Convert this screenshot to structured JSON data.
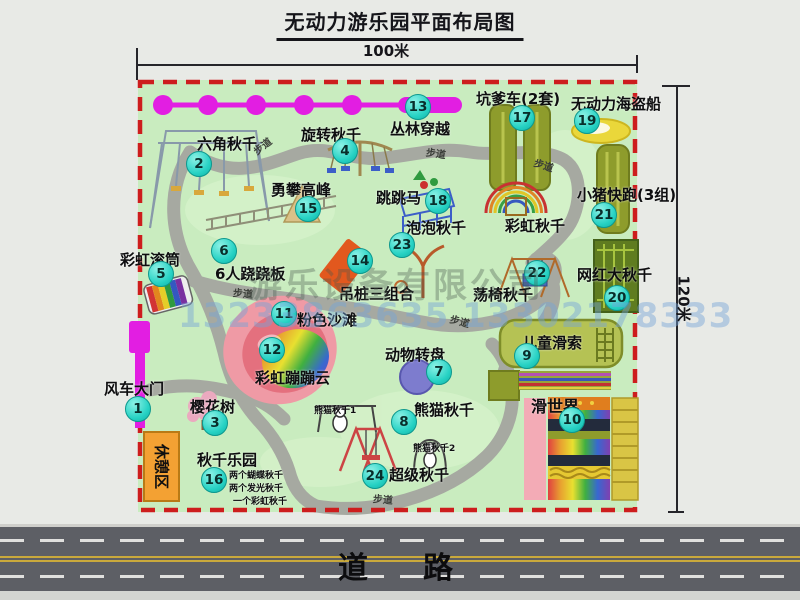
{
  "title": "无动力游乐园平面布局图",
  "dimensions": {
    "width": "100米",
    "height": "120米"
  },
  "road_label": "道路",
  "rest_area_label": "休憩区",
  "walkway_label": "步道",
  "watermark": {
    "line1": "游乐设备有限公司",
    "line2": "13233863635 13302178333"
  },
  "colors": {
    "park_green": "#c9ecbf",
    "boundary_red": "#cd1d1d",
    "path_gray": "#a6a9a1",
    "badge_teal": "#27d2c4",
    "zipline_magenta": "#e21ee2",
    "gate_magenta": "#e21ee2",
    "rest_orange": "#f3a133",
    "road_gray": "#5d5f65",
    "track_olive": "#8e9c2c",
    "boat_yellow": "#ead73a",
    "sand_pink": "#ef9aa5"
  },
  "markers": [
    {
      "num": "1",
      "name": "风车大门",
      "bx": 138,
      "by": 409,
      "lx": 104,
      "ly": 378
    },
    {
      "num": "2",
      "name": "六角秋千",
      "bx": 199,
      "by": 164,
      "lx": 197,
      "ly": 133
    },
    {
      "num": "3",
      "name": "樱花树",
      "bx": 215,
      "by": 423,
      "lx": 190,
      "ly": 396
    },
    {
      "num": "4",
      "name": "旋转秋千",
      "bx": 345,
      "by": 151,
      "lx": 301,
      "ly": 124
    },
    {
      "num": "5",
      "name": "彩虹滚筒",
      "bx": 161,
      "by": 274,
      "lx": 120,
      "ly": 249
    },
    {
      "num": "6",
      "name": "6人跷跷板",
      "bx": 224,
      "by": 251,
      "lx": 215,
      "ly": 263
    },
    {
      "num": "7",
      "name": "动物转盘",
      "bx": 439,
      "by": 372,
      "lx": 385,
      "ly": 344
    },
    {
      "num": "8",
      "name": "熊猫秋千",
      "bx": 404,
      "by": 422,
      "lx": 414,
      "ly": 399
    },
    {
      "num": "9",
      "name": "儿童滑索",
      "bx": 527,
      "by": 356,
      "lx": 522,
      "ly": 332
    },
    {
      "num": "10",
      "name": "滑世界",
      "bx": 572,
      "by": 420,
      "lx": 531,
      "ly": 393,
      "size": 16
    },
    {
      "num": "11",
      "name": "粉色沙滩",
      "bx": 284,
      "by": 314,
      "lx": 297,
      "ly": 309
    },
    {
      "num": "12",
      "name": "彩虹蹦蹦云",
      "bx": 272,
      "by": 350,
      "lx": 255,
      "ly": 367
    },
    {
      "num": "13",
      "name": "丛林穿越",
      "bx": 418,
      "by": 107,
      "lx": 390,
      "ly": 118
    },
    {
      "num": "14",
      "name": "吊桩三组合",
      "bx": 360,
      "by": 261,
      "lx": 339,
      "ly": 283
    },
    {
      "num": "15",
      "name": "勇攀高峰",
      "bx": 308,
      "by": 209,
      "lx": 271,
      "ly": 179
    },
    {
      "num": "16",
      "name": "秋千乐园",
      "bx": 214,
      "by": 480,
      "lx": 197,
      "ly": 449
    },
    {
      "num": "17",
      "name": "坑爹车(2套)",
      "bx": 522,
      "by": 118,
      "lx": 476,
      "ly": 88
    },
    {
      "num": "18",
      "name": "跳跳马",
      "bx": 438,
      "by": 201,
      "lx": 376,
      "ly": 187
    },
    {
      "num": "19",
      "name": "无动力海盗船",
      "bx": 587,
      "by": 121,
      "lx": 571,
      "ly": 93
    },
    {
      "num": "20",
      "name": "网红大秋千",
      "bx": 617,
      "by": 298,
      "lx": 577,
      "ly": 264
    },
    {
      "num": "21",
      "name": "小猪快跑(3组)",
      "bx": 604,
      "by": 215,
      "lx": 577,
      "ly": 184
    },
    {
      "num": "22",
      "name": "荡椅秋千",
      "bx": 537,
      "by": 273,
      "lx": 473,
      "ly": 284
    },
    {
      "num": "23",
      "name": "泡泡秋千",
      "bx": 402,
      "by": 245,
      "lx": 406,
      "ly": 217
    },
    {
      "num": "24",
      "name": "超级秋千",
      "bx": 375,
      "by": 476,
      "lx": 389,
      "ly": 464
    }
  ],
  "extra_labels": [
    {
      "text": "彩虹秋千",
      "x": 505,
      "y": 215,
      "size": 15
    },
    {
      "text": "熊猫秋千1",
      "x": 314,
      "y": 403,
      "size": 9
    },
    {
      "text": "熊猫秋千2",
      "x": 413,
      "y": 441,
      "size": 9
    },
    {
      "text": "两个蝴蝶秋千",
      "x": 229,
      "y": 468,
      "size": 9
    },
    {
      "text": "两个发光秋千",
      "x": 229,
      "y": 481,
      "size": 9
    },
    {
      "text": "一个彩虹秋千",
      "x": 233,
      "y": 494,
      "size": 9
    }
  ],
  "walkways": [
    {
      "x": 252,
      "y": 138,
      "rot": -38
    },
    {
      "x": 426,
      "y": 145,
      "rot": 8
    },
    {
      "x": 534,
      "y": 157,
      "rot": 18
    },
    {
      "x": 233,
      "y": 285,
      "rot": 5
    },
    {
      "x": 450,
      "y": 313,
      "rot": 15
    },
    {
      "x": 373,
      "y": 491,
      "rot": 5
    }
  ]
}
